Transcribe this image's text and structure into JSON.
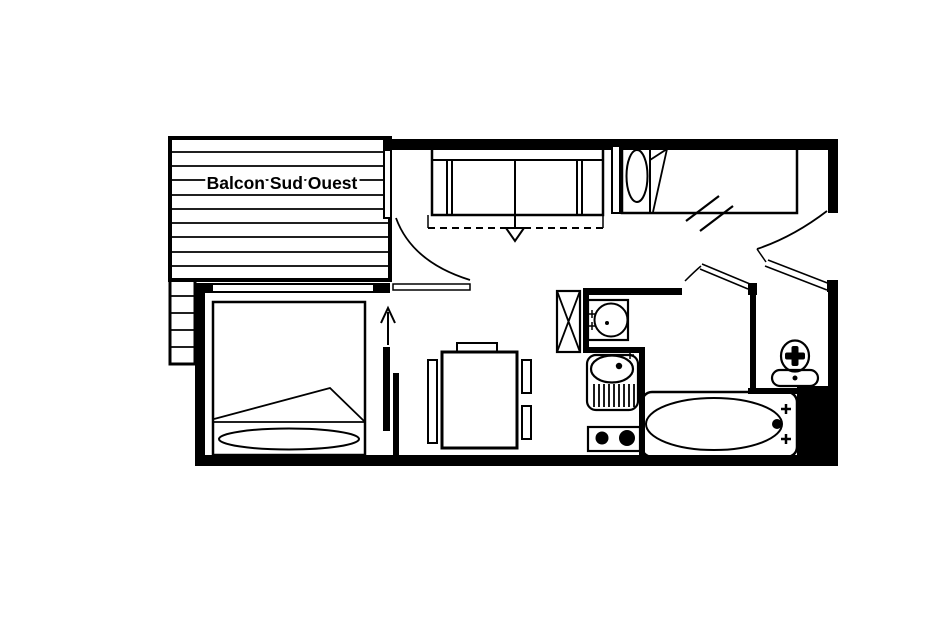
{
  "meta": {
    "kind": "apartment-floor-plan",
    "width": 940,
    "height": 627
  },
  "colors": {
    "ink": "#000000",
    "background": "#ffffff"
  },
  "balcony": {
    "label": "Balcon Sud Ouest"
  },
  "symbols": {
    "rooms": [
      "balcony",
      "bedroom",
      "living-room",
      "kitchenette",
      "bathroom",
      "wc",
      "entry"
    ],
    "furniture": [
      "double-bed",
      "single-bed",
      "sofa-bed",
      "sofa-bed-unfold-arrow",
      "dining-table",
      "chairs",
      "sliding-door",
      "slide-direction-arrow",
      "closet-x",
      "washbasin",
      "kitchen-sink",
      "two-burner-stove",
      "bathtub",
      "toilet",
      "door-swing-arcs",
      "window-slashes"
    ]
  }
}
